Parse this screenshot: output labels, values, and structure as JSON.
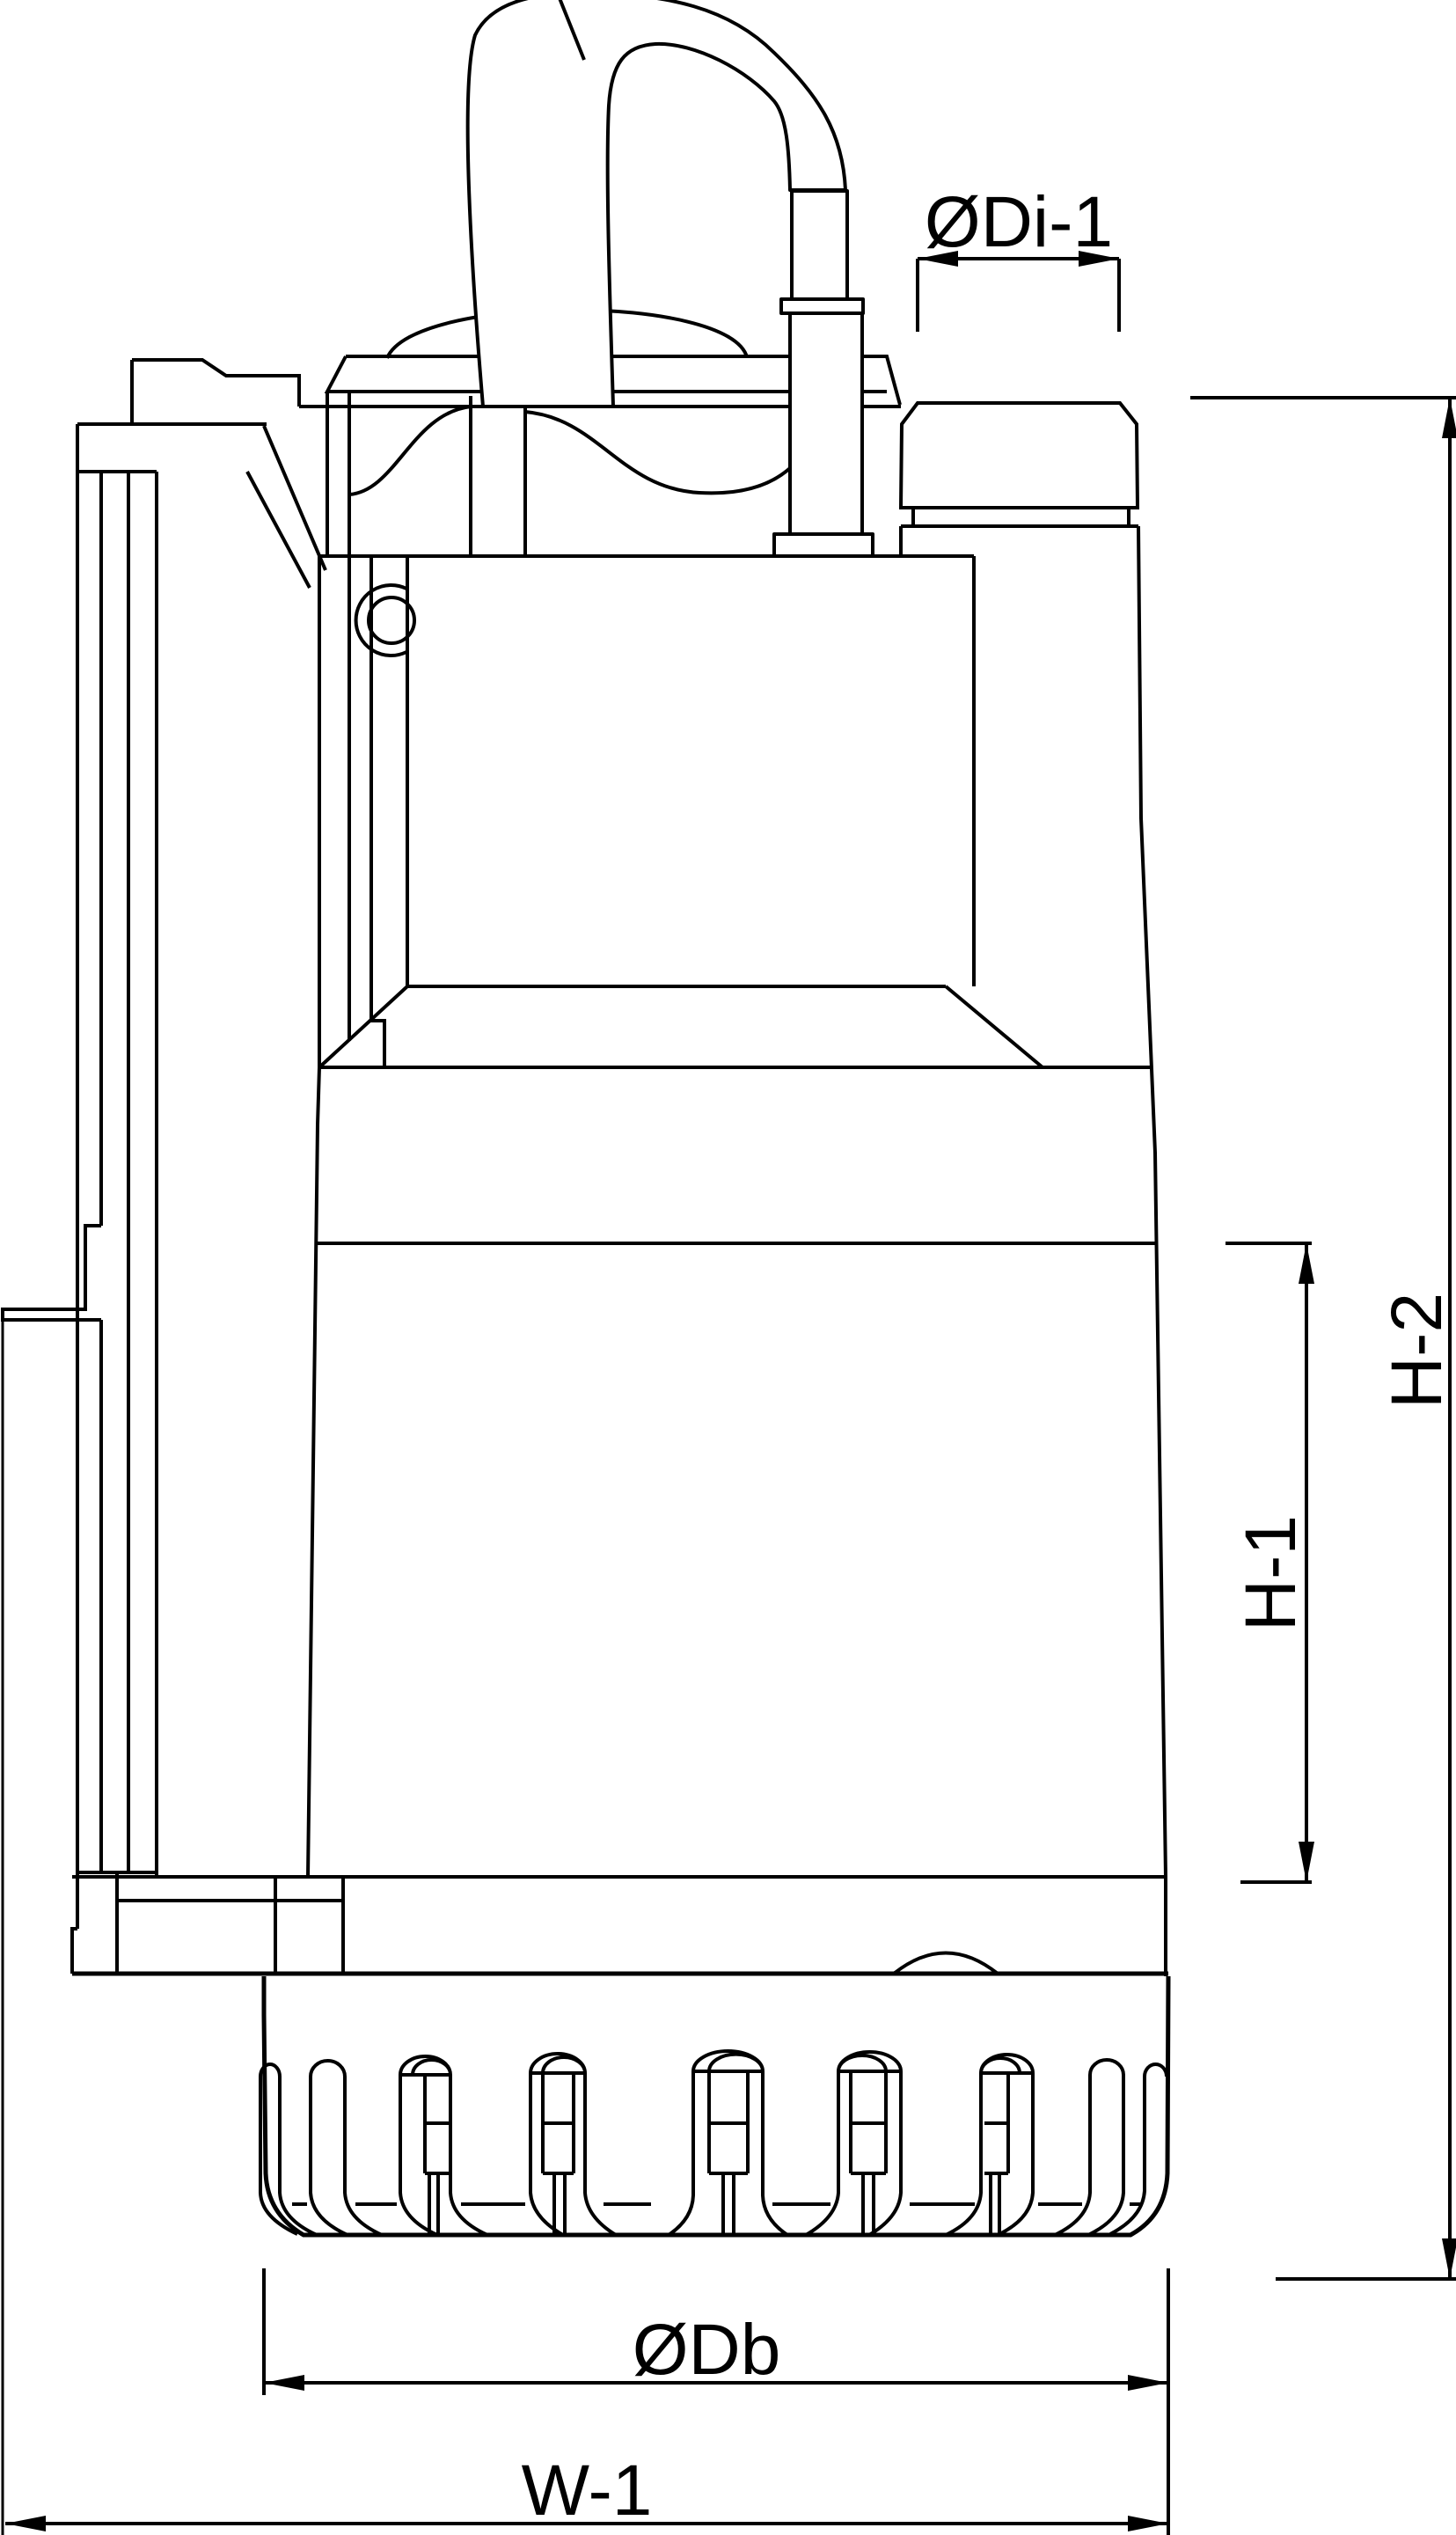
{
  "diagram": {
    "kind": "technical-dimension-drawing",
    "colors": {
      "background": "#ffffff",
      "line": "#000000"
    },
    "labels": {
      "outlet_diameter": "ØDi-1",
      "total_height": "H-2",
      "casing_height": "H-1",
      "base_diameter": "ØDb",
      "overall_width": "W-1"
    }
  }
}
